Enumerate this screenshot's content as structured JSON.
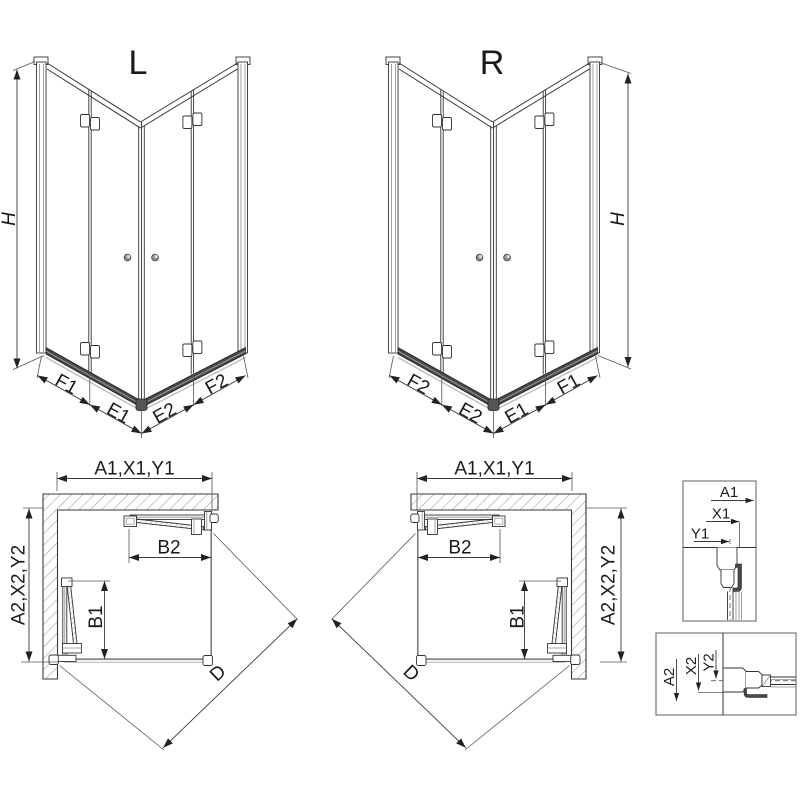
{
  "document": {
    "type": "shower-enclosure-technical-drawing",
    "background": "#ffffff"
  },
  "views": {
    "iso_left": {
      "title": "L",
      "height_dim": "H",
      "bottom_dims": [
        "F1",
        "E1",
        "E2",
        "F2"
      ]
    },
    "iso_right": {
      "title": "R",
      "height_dim": "H",
      "bottom_dims": [
        "F2",
        "E2",
        "E1",
        "F1"
      ]
    },
    "plan_left": {
      "width_dim": "A1,X1,Y1",
      "depth_dim": "A2,X2,Y2",
      "door_top_dim": "B2",
      "door_side_dim": "B1",
      "diagonal_dim": "D"
    },
    "plan_right": {
      "width_dim": "A1,X1,Y1",
      "depth_dim": "A2,X2,Y2",
      "door_top_dim": "B2",
      "door_side_dim": "B1",
      "diagonal_dim": "D"
    },
    "detail_wall_profile_horizontal": {
      "dims": [
        "A1",
        "X1",
        "Y1"
      ]
    },
    "detail_wall_profile_vertical": {
      "dims": [
        "A2",
        "X2",
        "Y2"
      ]
    }
  },
  "colors": {
    "line": "#333333",
    "dimension": "#3a3a3a",
    "hatch": "#9a9a9a",
    "rail_dark": "#474747",
    "tray_light": "#c6c6c6"
  }
}
